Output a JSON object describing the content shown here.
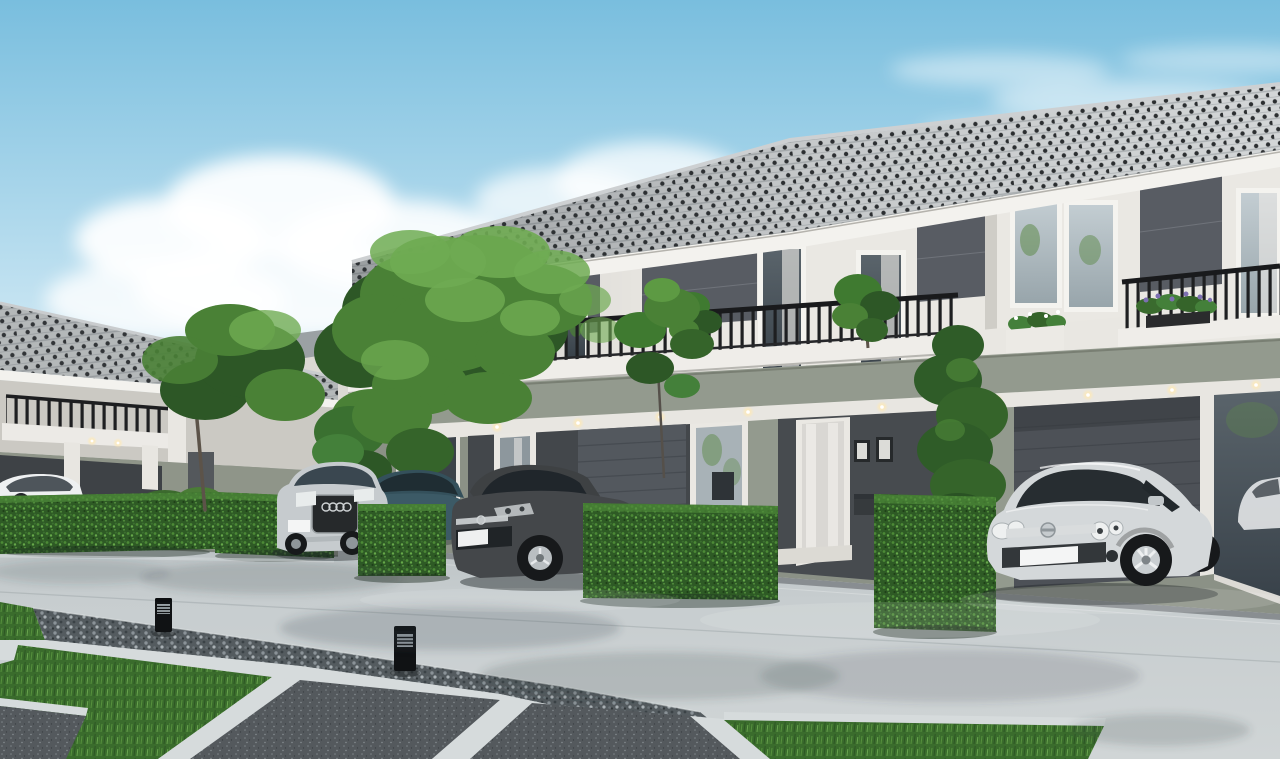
{
  "scene": {
    "type": "architectural-3d-render",
    "setting": "Modern two-story townhouse row with carports, parked cars, trimmed hedges, lawn and concrete driveway under a blue sky",
    "objects": [
      "two-story townhouse row",
      "left detached house",
      "background house",
      "large garden tree",
      "small sapling tree",
      "cypress shrub",
      "trimmed hedges",
      "silver suv",
      "teal coupe",
      "dark gray coupe",
      "silver hatchback",
      "white parked car",
      "white car reflection in glass",
      "balcony railings",
      "balcony plants",
      "purple flower planter",
      "recessed downlights",
      "concrete driveway",
      "gravel strip",
      "granite paver slabs",
      "lawn patches",
      "bollard path lights",
      "clouds"
    ],
    "palette": {
      "sky_top": "#79bede",
      "sky_mid": "#c2e2f1",
      "sky_horizon": "#f3f8f9",
      "cloud": "#ffffff",
      "roof_tile": "#d3d6d7",
      "roof_dot": "#2b2e30",
      "fascia": "#f3f2ee",
      "wall_white": "#eae8e3",
      "dark_panel": "#585c63",
      "sage_wall": "#939a8e",
      "ground_floor": "#8b9186",
      "porch_dark": "#43474b",
      "soffit": "#e8e6e1",
      "railing_dark": "#1e1f21",
      "glass_light": "#b9c4ca",
      "glass_dark": "#3f484e",
      "hedge_green": "#2e5a25",
      "hedge_light": "#5d9a43",
      "grass_green": "#3a6c2c",
      "grass_light": "#5d9440",
      "concrete_top": "#adb4b7",
      "concrete_mid": "#c7cdcf",
      "concrete_bottom": "#d0d5d6",
      "gravel_dark": "#545b5f",
      "granite": "#54595d",
      "curb_light": "#d6dbdc",
      "trunk_brown": "#5c5349",
      "foliage": "#4a8136",
      "foliage_dark": "#2d5726",
      "foliage_light": "#6fab52",
      "car_white": "#eef0f1",
      "car_silver_suv": "#c6cbce",
      "car_teal": "#3c5a66",
      "car_gray": "#44474a",
      "car_silver_hatch": "#d4d8da",
      "tire": "#17191b",
      "rim": "#c9ced1",
      "chrome": "#e9ebec",
      "plate": "#f4f5f5",
      "downlight": "#ffe9b4",
      "flower_purple": "#7d6fb2"
    }
  }
}
